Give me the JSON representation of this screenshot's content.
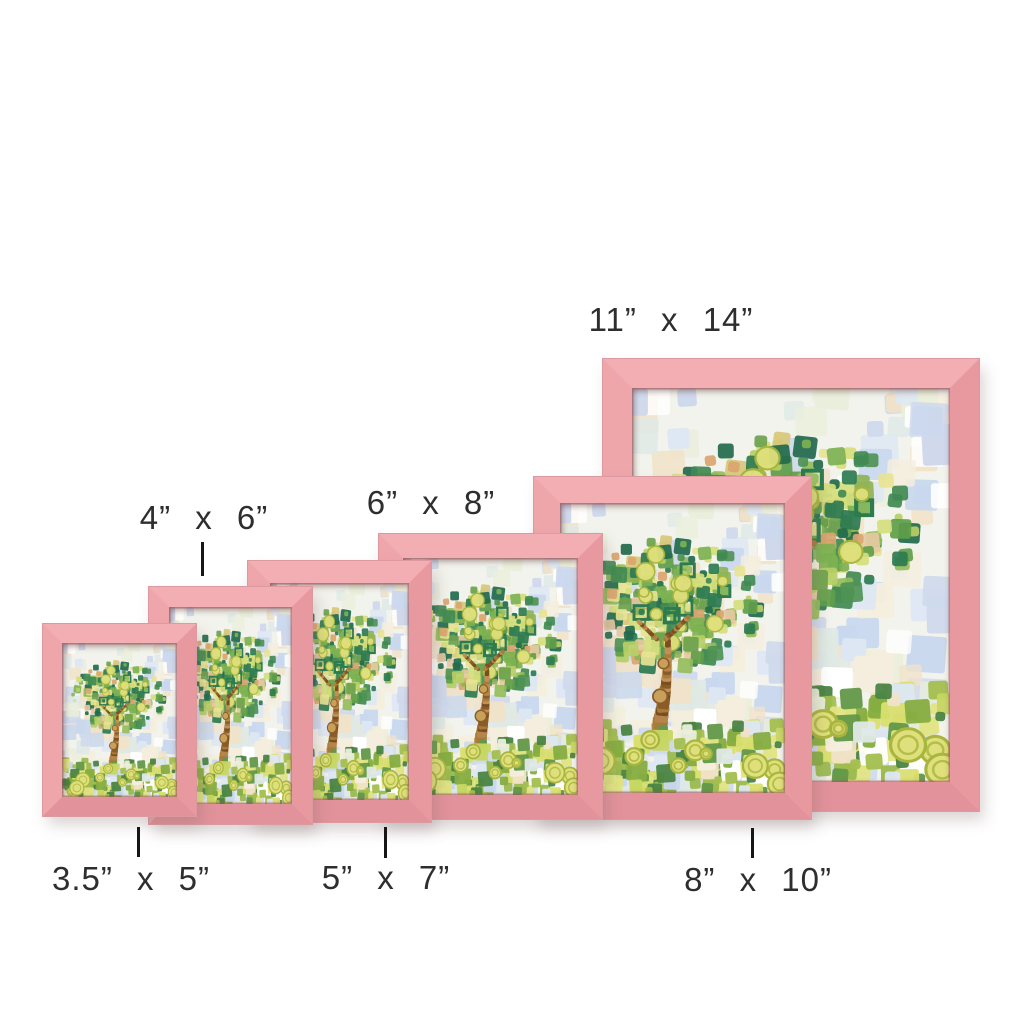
{
  "title": "Picture frame size comparison",
  "background_color": "#ffffff",
  "label_text_color": "#2e2e2e",
  "frame_style": {
    "color_name": "blush pink wood",
    "face": "#efa3a8",
    "face_light": "#f3aeb3",
    "face_dark": "#e2929a",
    "lip": "#c97f86"
  },
  "artwork": {
    "description": "mosaic tree painting, green foliage of small square brushstrokes on pale blue and cream patchwork sky, tan trunk with knots, yellow-green swirl circles on grassy ground",
    "palette": {
      "background": "#f2f3ec",
      "sky": [
        "#ffffff",
        "#dde7f4",
        "#c9d8ee",
        "#f5eedd",
        "#eaeedb",
        "#f1e2c8",
        "#dfe9e6",
        "#cfd9ec"
      ],
      "foliage": [
        "#7db253",
        "#5f9e49",
        "#418a52",
        "#2d7b51",
        "#95bd5a",
        "#b7cf66",
        "#d6de7d",
        "#e7e494",
        "#226a4c",
        "#6ea24f",
        "#8fb357",
        "#4f9355"
      ],
      "accents": [
        "#d7c878",
        "#e5c9a2",
        "#dba56f"
      ],
      "trunk": [
        "#a87b3b",
        "#8a5d28",
        "#c09057",
        "#7a4e20",
        "#b5854a"
      ],
      "knot_fill": "#c9a05a",
      "knot_ring": "#8a5d28",
      "ground": [
        "#a3bf4f",
        "#c6d663",
        "#86ad41",
        "#629849",
        "#e2e482",
        "#4b8443",
        "#9cb94e",
        "#d9df6f"
      ],
      "circles": "#dfe07b",
      "circle_ring": "#a8b53e",
      "hollow_square": "#2d7b51"
    }
  },
  "sizes": [
    {
      "id": "3.5x5",
      "label": "3.5” x 5”",
      "label_position": "bottom"
    },
    {
      "id": "4x6",
      "label": "4” x 6”",
      "label_position": "top"
    },
    {
      "id": "5x7",
      "label": "5” x 7”",
      "label_position": "bottom"
    },
    {
      "id": "6x8",
      "label": "6” x 8”",
      "label_position": "top"
    },
    {
      "id": "8x10",
      "label": "8” x 10”",
      "label_position": "bottom"
    },
    {
      "id": "11x14",
      "label": "11” x 14”",
      "label_position": "top"
    }
  ]
}
